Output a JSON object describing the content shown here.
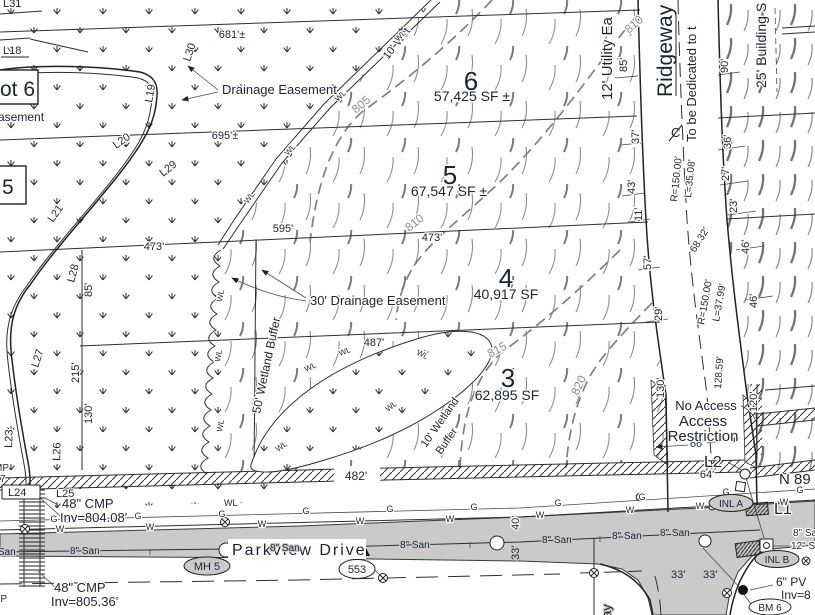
{
  "palette": {
    "paper": "#ffffff",
    "ink": "#2b2f33",
    "dim_text": "#1c2430",
    "road_gray": "#cacaca",
    "contour_gray": "#8d8d8d"
  },
  "lots": {
    "lot6": {
      "num": "6",
      "area": "57,425 SF ±"
    },
    "lot5": {
      "num": "5",
      "area": "67,547 SF ±"
    },
    "lot4": {
      "num": "4",
      "area": "40,917 SF"
    },
    "lot3": {
      "num": "3",
      "area": "62,895 SF"
    },
    "adj6": "ot 6",
    "adj5": "5",
    "asement": "asement"
  },
  "streets": {
    "parkview": "Parkview Drive",
    "ridgeway": "Ridgeway",
    "ridgeway_south": "ay"
  },
  "easements": {
    "drainage": "Drainage Easement",
    "drainage30": "30' Drainage Easement",
    "utility": "12' Utility Ea",
    "building": "25' Building S",
    "dedicated": "To be Dedicated to t",
    "cl": "C",
    "wetbuf50": "50' Wetland Buffer",
    "wet10": "10' Wet",
    "wetbuf10a": "10' Wetland",
    "wetbuf10b": "Buffer",
    "wl": "WL"
  },
  "contours": {
    "c805": "805",
    "c810": "810",
    "c815": "815",
    "c820": "820"
  },
  "dims": {
    "d681": "681'±",
    "d695": "695'±",
    "d595": "595'",
    "d473a": "473'",
    "d473b": "473'",
    "d487": "487'",
    "d482": "482'",
    "d85a": "85'",
    "d85b": "85'",
    "d215": "215'",
    "d130a": "130'",
    "d130b": "130'",
    "d120": "120'",
    "d90": "90'",
    "d36": "36'",
    "d37": "37'",
    "d43": "43'",
    "d11": "11'",
    "d57": "57'",
    "d29": "29'",
    "d27": "27'",
    "d23": "23'",
    "d46a": "46'",
    "d46b": "46'",
    "d66": "66'",
    "d64": "64'",
    "d33a": "33'",
    "d33b": "33'",
    "d33c": "33'",
    "d40": "40'",
    "c1l": "L=35.08'",
    "c1r": "R=150.00'",
    "c2l": "L=37.99'",
    "c2r": "R=150.00'",
    "d6832": "68.32'",
    "d12859": "128.59'",
    "bearing": "N 89"
  },
  "ltags": {
    "L31": "L31",
    "L18": "L18",
    "L19": "L19",
    "L20": "L20",
    "L21": "L21",
    "L23": "L23",
    "L24": "L24",
    "L25": "L25",
    "L26": "L26",
    "L27": "L27",
    "L28": "L28",
    "L29": "L29",
    "L30": "L30",
    "L1": "L1",
    "L2": "L2"
  },
  "util": {
    "cmp1": "48\" CMP",
    "inv1": "Inv=804.08'",
    "cmp2": "48\" CMP",
    "inv2": "Inv=805.36'",
    "san": "8\" San",
    "gas": "G",
    "wat": "W",
    "wl": "WL",
    "sto": "12\" Sto",
    "pvc": "6\" PV",
    "invp": "Inv=8",
    "mp": "MP",
    "p7": "7",
    "p0": "0'"
  },
  "structures": {
    "mh5": "MH 5",
    "t553": "553",
    "inla": "INL A",
    "inlb": "INL B",
    "bm6": "BM 6"
  },
  "notes": {
    "noacc": "No Access",
    "acc1": "Access",
    "acc2": "Restriction"
  }
}
